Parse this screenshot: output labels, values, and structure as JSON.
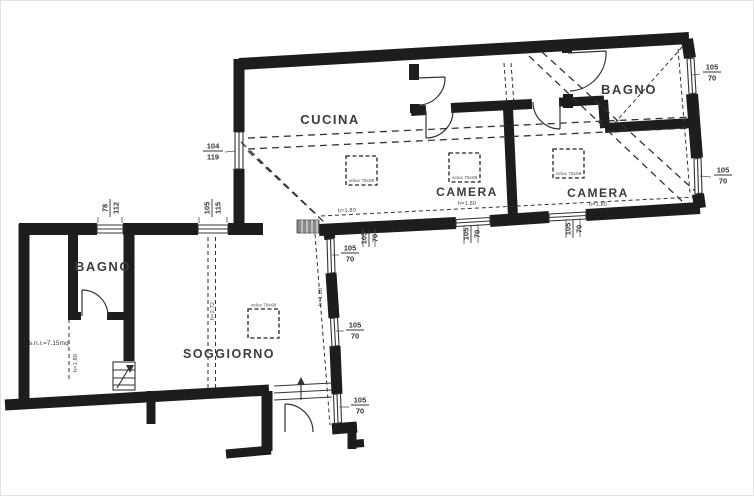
{
  "rooms": {
    "cucina": "CUCINA",
    "camera_1": "CAMERA",
    "camera_2": "CAMERA",
    "bagno_top": "BAGNO",
    "bagno_left": "BAGNO",
    "soggiorno": "SOGGIORNO"
  },
  "annotations": {
    "h180": "h=1.80",
    "h272": "h=2.72",
    "area_snr": "s.n.r.=7.15mq",
    "velux": "velux 78x98"
  },
  "dimensions": {
    "d104_119": {
      "top": "104",
      "bottom": "119"
    },
    "d78_112": {
      "top": "78",
      "bottom": "112"
    },
    "d105_115": {
      "top": "105",
      "bottom": "115"
    },
    "d105_70": {
      "top": "105",
      "bottom": "70"
    }
  },
  "colors": {
    "wall": "#1d1d1d",
    "line": "#333333",
    "text": "#3c3c3c",
    "background": "#ffffff"
  }
}
